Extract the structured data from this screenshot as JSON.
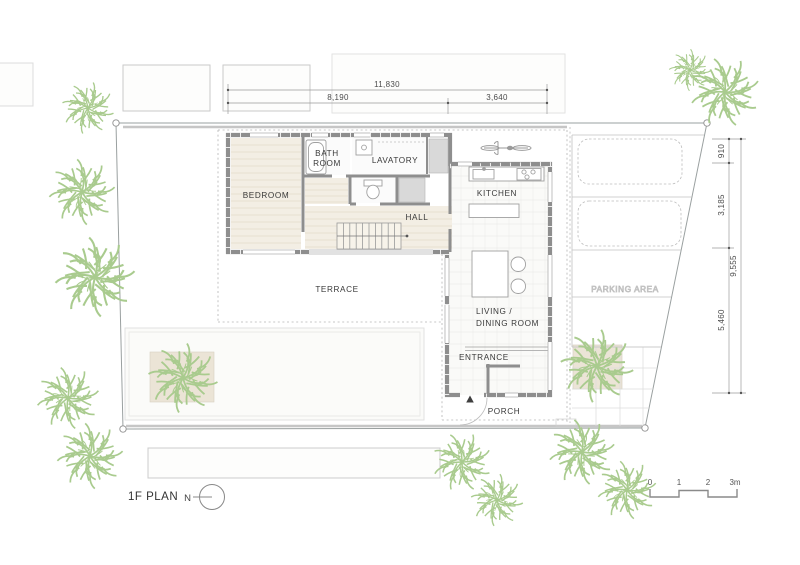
{
  "title": {
    "plan_label": "1F PLAN",
    "north_label": "N"
  },
  "rooms": {
    "bedroom": "BEDROOM",
    "bath_line1": "BATH",
    "bath_line2": "ROOM",
    "lavatory": "LAVATORY",
    "hall": "HALL",
    "kitchen": "KITCHEN",
    "living_line1": "LIVING /",
    "living_line2": "DINING ROOM",
    "entrance": "ENTRANCE",
    "porch": "PORCH",
    "terrace": "TERRACE",
    "parking": "PARKING AREA"
  },
  "dimensions": {
    "top": {
      "total": "11,830",
      "left": "8,190",
      "right": "3,640"
    },
    "right": {
      "seg1": "910",
      "seg2": "3,185",
      "seg3": "5,460",
      "total": "9,555"
    }
  },
  "scale_bar": {
    "t0": "0",
    "t1": "1",
    "t2": "2",
    "t3": "3m"
  },
  "colors": {
    "wall": "#8e8e8e",
    "wood_floor": "#f3eee4",
    "tree_green": "#a9cb8e",
    "boundary_gray": "#9aa0a0",
    "patch_beige": "#ebe4d6"
  }
}
